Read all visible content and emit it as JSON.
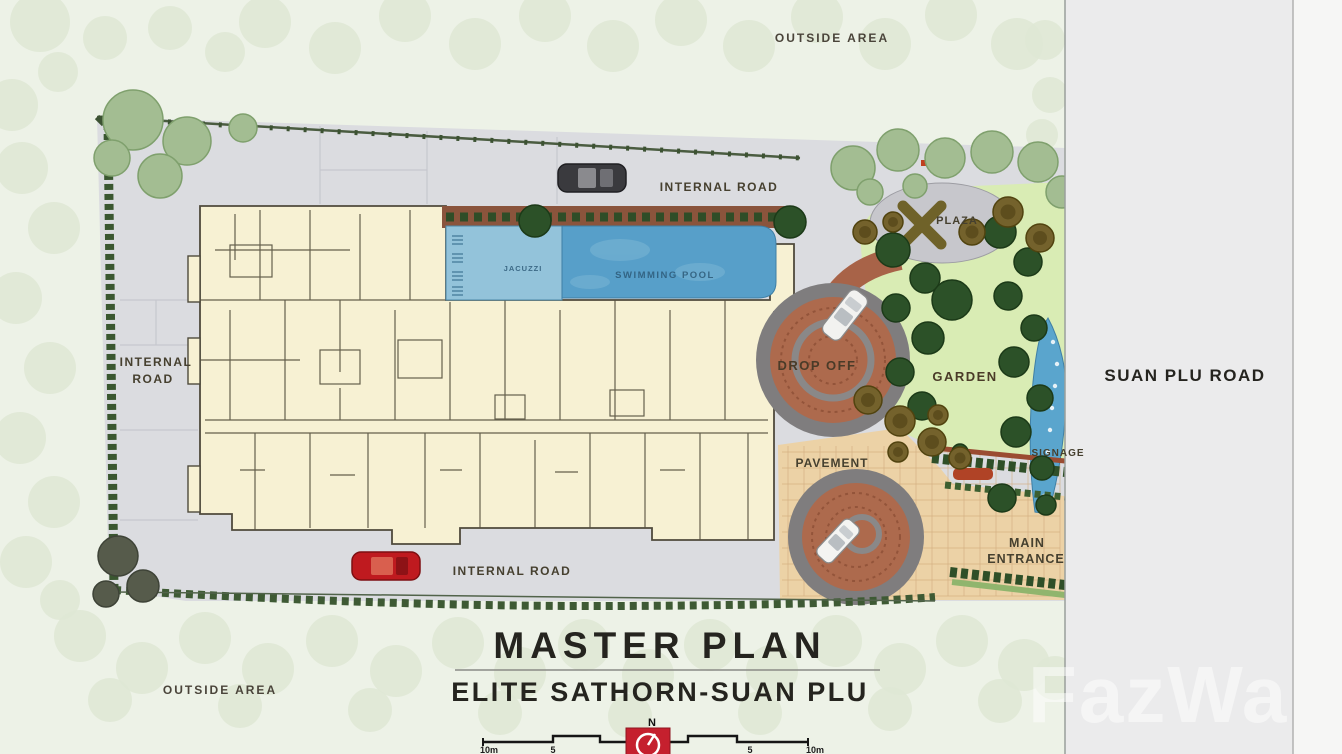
{
  "plan": {
    "title": "MASTER PLAN",
    "subtitle": "ELITE SATHORN-SUAN PLU",
    "watermark": "FazWa",
    "compass_north": "N",
    "scale_labels": [
      "10m",
      "5",
      "5",
      "10m"
    ]
  },
  "labels": {
    "outside_area_top": "OUTSIDE AREA",
    "outside_area_bottom": "OUTSIDE AREA",
    "internal_road_top": "INTERNAL ROAD",
    "internal_road_left_line1": "INTERNAL",
    "internal_road_left_line2": "ROAD",
    "internal_road_bottom": "INTERNAL ROAD",
    "suan_plu_road": "SUAN PLU ROAD",
    "plaza": "PLAZA",
    "garden": "GARDEN",
    "drop_off": "DROP OFF",
    "pavement": "PAVEMENT",
    "signage": "SIGNAGE",
    "main_entrance_line1": "MAIN",
    "main_entrance_line2": "ENTRANCE",
    "swimming_pool": "SWIMMING POOL",
    "jacuzzi": "JACUZZI"
  },
  "colors": {
    "background_green": "#edf2e7",
    "pale_tree": "#dfe8d5",
    "road_gray": "#dbdce0",
    "building_cream": "#f7f1d3",
    "building_wall": "#56503e",
    "pool_blue": "#579fc9",
    "pool_blue_light": "#93c3da",
    "garden_green": "#d9ecb4",
    "dark_tree": "#2c5128",
    "sage_tree": "#a3bd92",
    "olive_tree": "#74622c",
    "brick_dropoff": "#ad6a4d",
    "ring_gray": "#7f7d7e",
    "pavement_tan": "#ecd2a6",
    "hedge_green": "#2f4f28",
    "compass_red": "#c5202e",
    "label_brown": "#46402f",
    "suan_plu_white": "#ebebec"
  }
}
